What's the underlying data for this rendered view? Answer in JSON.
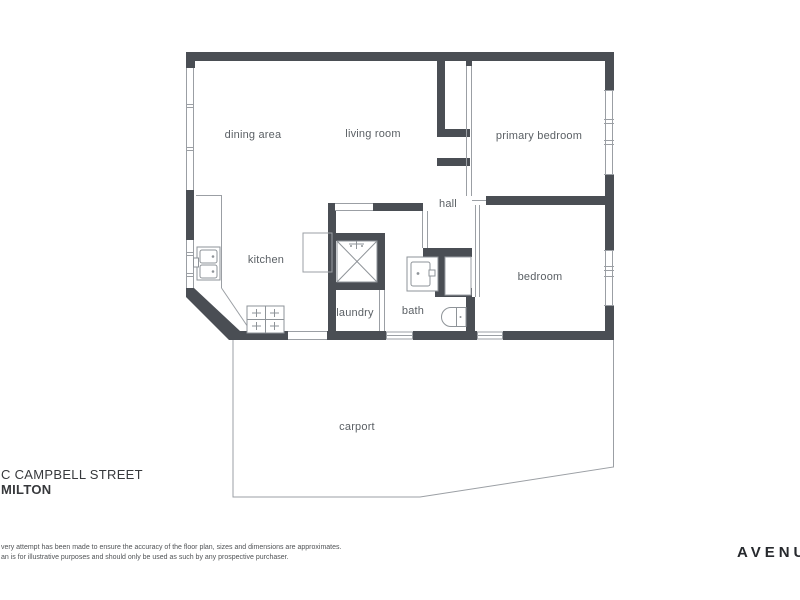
{
  "page": {
    "background": "#ffffff"
  },
  "colors": {
    "wall": "#4a4e54",
    "thin_line": "#9b9fa4",
    "fixture_line": "#8e9398",
    "room_label": "#5b6065",
    "address_text": "#37393c",
    "disclaimer_text": "#505356",
    "logo_text": "#26292d"
  },
  "floor_plan": {
    "rooms": [
      {
        "label": "dining area"
      },
      {
        "label": "living room"
      },
      {
        "label": "primary bedroom"
      },
      {
        "label": "hall"
      },
      {
        "label": "kitchen"
      },
      {
        "label": "laundry"
      },
      {
        "label": "bath"
      },
      {
        "label": "bedroom"
      },
      {
        "label": "carport"
      }
    ],
    "fixtures": [
      "kitchen-sink",
      "cooktop",
      "refrigerator",
      "laundry-tub",
      "vanity-basin",
      "toilet"
    ]
  },
  "address": {
    "line1": "C CAMPBELL STREET",
    "line2": "MILTON"
  },
  "disclaimer": {
    "line1": "very attempt has been made to ensure the accuracy of the floor plan, sizes and dimensions are approximates.",
    "line2": "an is for illustrative purposes and should only be used as such by any prospective purchaser."
  },
  "brand": {
    "logo": "AVENU"
  }
}
